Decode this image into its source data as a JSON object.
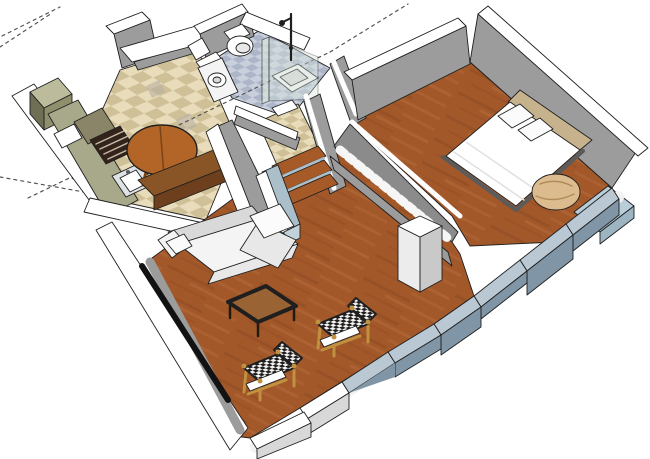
{
  "scene": {
    "title": "3D apartment floor plan render",
    "view": "axonometric cutaway from above",
    "rooms": [
      {
        "name": "kitchen",
        "floor": "beige-checker-tile",
        "position": "top-left"
      },
      {
        "name": "bathroom",
        "floor": "blue-gray-tile",
        "position": "top-center"
      },
      {
        "name": "hall-landing",
        "floor": "beige-tile",
        "position": "center"
      },
      {
        "name": "living-room",
        "floor": "wood-plank",
        "position": "center-bottom"
      },
      {
        "name": "bedroom",
        "floor": "wood-plank",
        "position": "right"
      }
    ],
    "furniture": [
      "tall-cabinet",
      "kitchen-counter",
      "oven",
      "kitchen-sink",
      "round-dining-table",
      "dining-bench",
      "toilet",
      "bathroom-vanity-sink",
      "glass-shower",
      "stairs",
      "stairwell-railing",
      "sectional-sofa",
      "throw-pillows",
      "coffee-table",
      "wicker-chair",
      "wicker-chair",
      "double-bed",
      "bed-pillows",
      "beanbag-chair",
      "bedroom-bench",
      "column",
      "parapet-low-walls",
      "window-slot",
      "axis-guide-lines"
    ]
  },
  "colors": {
    "outline": "#1f1f1f",
    "axis": "#555555",
    "cap": "#ffffff",
    "wall": "#9c9c9c",
    "wall_dark": "#8b8b8b",
    "wood": "#a3582a",
    "wood_dark": "#8a4a22",
    "wood_light": "#b56c3c",
    "tile_a": "#e8dcba",
    "tile_b": "#cfc098",
    "tile_gray": "#b5ada0",
    "bath_a": "#c9cfdc",
    "bath_b": "#adb6c9",
    "olive": "#8f8f6d",
    "olive_dark": "#6f6f55",
    "khaki_light": "#bcbc9d",
    "counter": "#a8a88a",
    "granite": "#8a8468",
    "oven": "#32241a",
    "oven_slat": "#c7b8a5",
    "steel": "#dfe3e6",
    "table": "#b26527",
    "table_dark": "#7a4418",
    "bench": "#8a5526",
    "bench_dark": "#6e3f1c",
    "stairs_wood": "#a65a28",
    "stair_paint": "#aabfca",
    "stair_paint_light": "#c2d2da",
    "low_top": "#b9c8d3",
    "low_side": "#8096a6",
    "glass": "#d8e5db",
    "glass_edge": "#5a6b63",
    "bed": "#ffffff",
    "frame": "#5b5b5b",
    "headboard": "#c7b28e",
    "pillow": "#fbfbfb",
    "crease": "#e0e0e0",
    "beanbag": "#dcbb8e",
    "beanbag_dark": "#b08c5a",
    "bench_blue": "#b9cdd9",
    "bench_blue_dark": "#9db4c2",
    "sofa": "#f4f4f4",
    "sofa_mid": "#e8e8e8",
    "sofa_dark": "#d9d9d9",
    "wicker_frame": "#c0913f",
    "wicker_dark": "#1d1d1d",
    "wicker_light": "#f2f2f2",
    "ctable_top": "#9a6333",
    "ctable_rim": "#241910",
    "window_dark": "#121212",
    "white_trim": "#f2f2f2",
    "column_w": "#ececec",
    "column_e": "#c9c9c9",
    "base_white": "#d8d8d8",
    "baluster": "#f6f6f6"
  }
}
